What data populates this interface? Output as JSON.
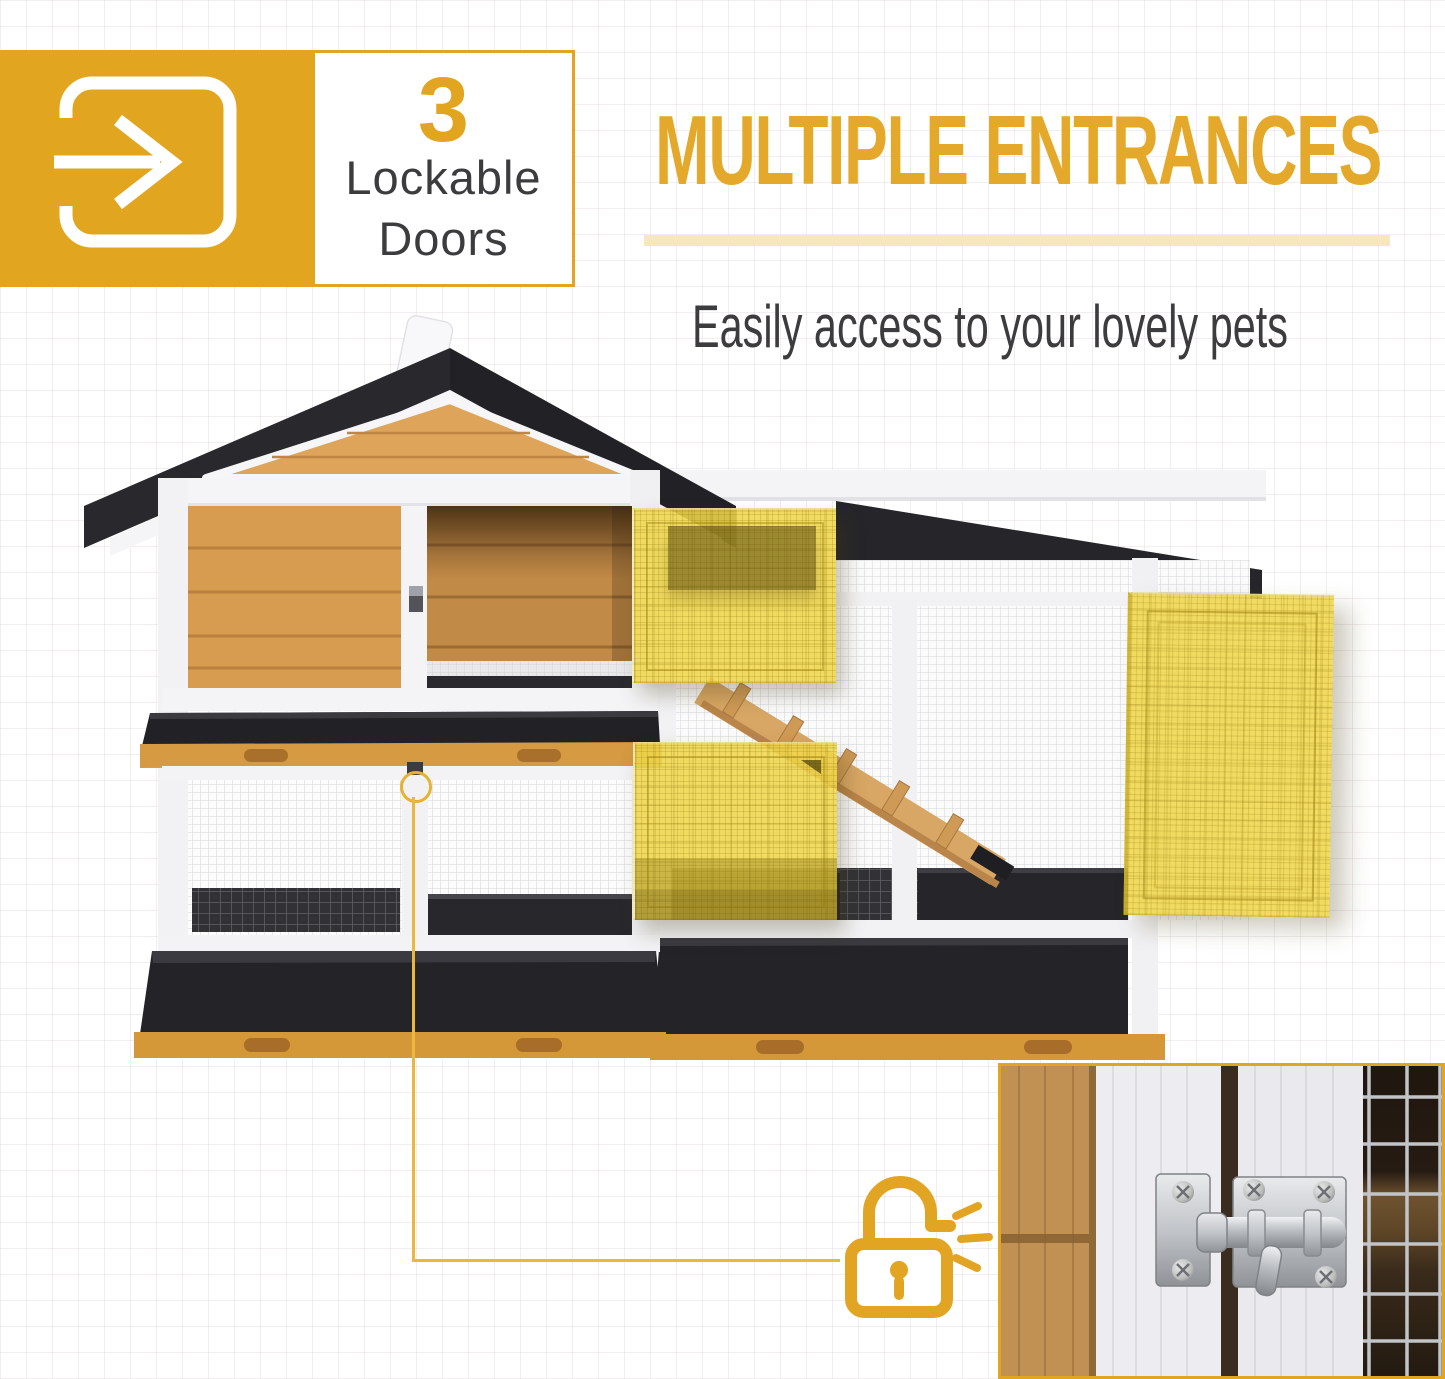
{
  "badge": {
    "icon": "enter-door-arrow-icon",
    "count": "3",
    "label_line1": "Lockable",
    "label_line2": "Doors"
  },
  "header": {
    "title": "MULTIPLE ENTRANCES",
    "subtitle": "Easily access to your lovely pets"
  },
  "callout": {
    "icon": "unlocked-padlock-icon",
    "emphasis_marks": "click-sparkle-marks"
  },
  "figures": {
    "product": "rabbit-hutch-photo",
    "closeup": "slide-bolt-latch-photo"
  },
  "colors": {
    "accent": "#E2A51F",
    "accent_line": "#E9B83C",
    "divider": "#F6E8BA",
    "heading_text": "#E4A92A",
    "body_text": "#3C3C3E",
    "door_highlight": "#EFD64A",
    "roof_black": "#28282C",
    "frame_white": "#F3F3F5",
    "wood_light": "#D79C4F",
    "wood_rail": "#D59838",
    "tray_black": "#232327",
    "mesh_line": "#D2D3D6"
  }
}
